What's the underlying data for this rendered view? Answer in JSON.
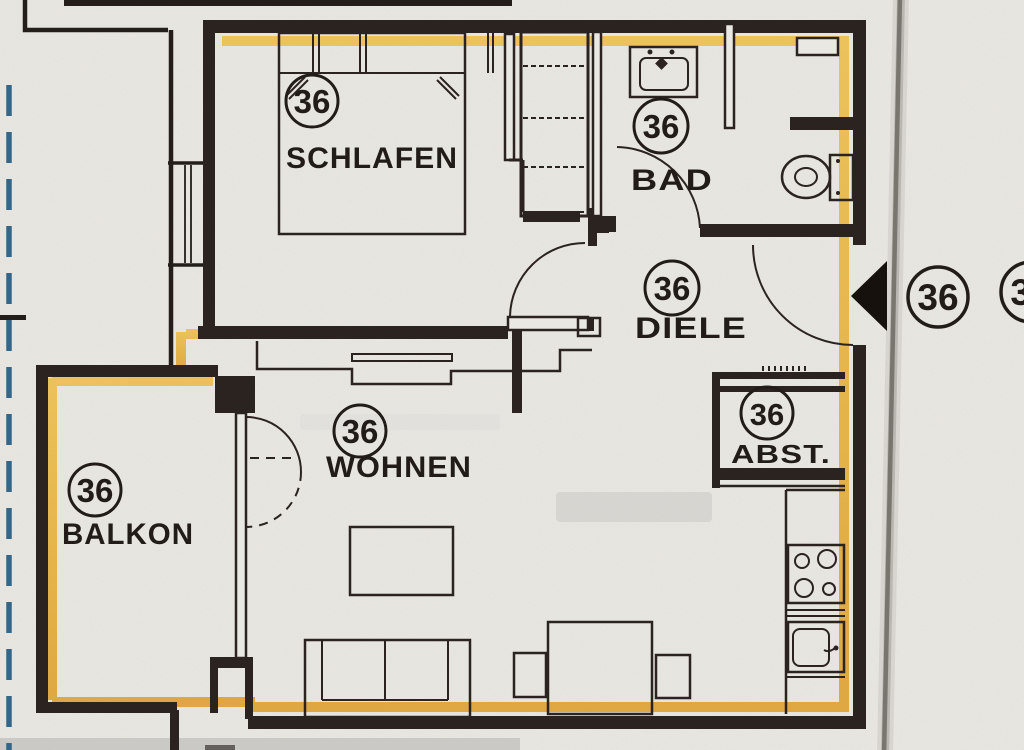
{
  "plan": {
    "unit_number": "36",
    "rooms": [
      {
        "key": "schlafen",
        "number": "36",
        "label": "SCHLAFEN"
      },
      {
        "key": "bad",
        "number": "36",
        "label": "BAD"
      },
      {
        "key": "diele",
        "number": "36",
        "label": "DIELE"
      },
      {
        "key": "abst",
        "number": "36",
        "label": "ABST."
      },
      {
        "key": "wohnen",
        "number": "36",
        "label": "WOHNEN"
      },
      {
        "key": "balkon",
        "number": "36",
        "label": "BALKON"
      }
    ],
    "outside_markers": [
      {
        "number": "36"
      },
      {
        "number": "36"
      }
    ],
    "furniture": [
      "double-bed",
      "wardrobe",
      "washbasin",
      "wc",
      "wall-shelf",
      "sideboard",
      "coffee-table",
      "sofa",
      "dining-table",
      "dining-chair",
      "dining-chair",
      "kitchen-counter",
      "stove",
      "kitchen-sink"
    ],
    "colors": {
      "paper": "#eae8e3",
      "ink": "#2b2320",
      "highlight_yellow": "#e6b13a",
      "dashed_blue": "#336688",
      "fold_gray": "#77756f"
    }
  }
}
